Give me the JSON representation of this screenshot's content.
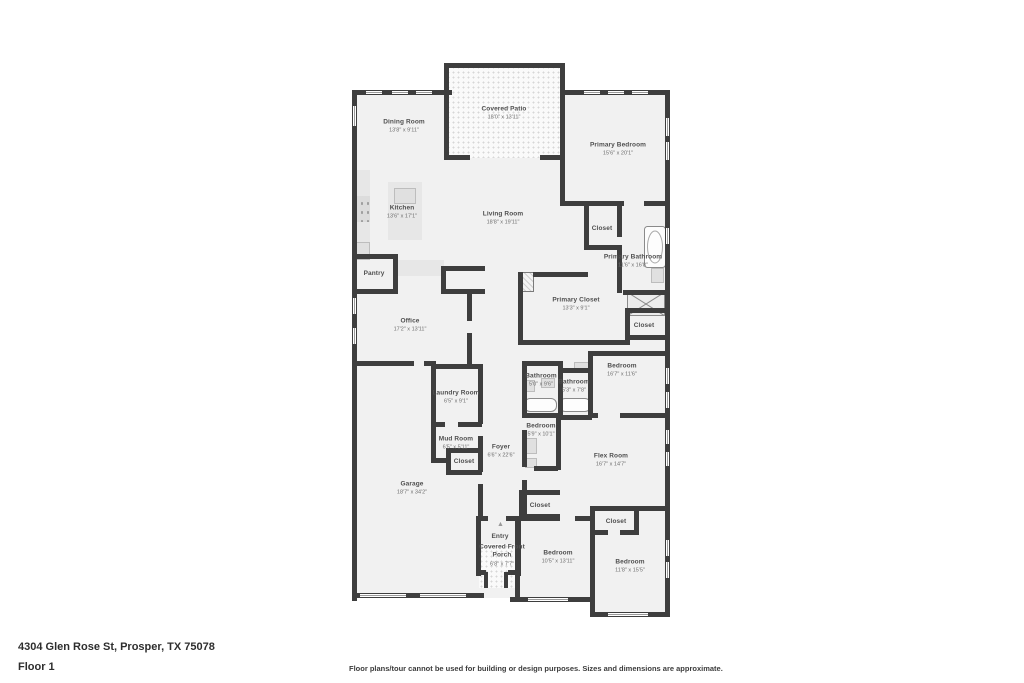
{
  "title": "Floor plan",
  "footer": {
    "address": "4304 Glen Rose St, Prosper, TX 75078",
    "floor_label": "Floor 1",
    "disclaimer": "Floor plans/tour cannot be used for building or design purposes. Sizes and dimensions are approximate."
  },
  "colors": {
    "wall": "#3e3e3e",
    "room_fill": "#f1f1f1",
    "patio_fill": "#fafafa",
    "label_text": "#4f4f4f"
  },
  "icons": {
    "entry_marker": "▲"
  },
  "rooms": [
    {
      "name": "Dining Room",
      "dims": "13'8\" x 9'11\""
    },
    {
      "name": "Covered Patio",
      "dims": "18'0\" x 13'11\""
    },
    {
      "name": "Primary Bedroom",
      "dims": "15'6\" x 20'1\""
    },
    {
      "name": "Kitchen",
      "dims": "13'6\" x 17'1\""
    },
    {
      "name": "Living Room",
      "dims": "18'8\" x 19'11\""
    },
    {
      "name": "Closet"
    },
    {
      "name": "Primary Bathroom",
      "dims": "11'6\" x 16'8\""
    },
    {
      "name": "Pantry"
    },
    {
      "name": "Primary Closet",
      "dims": "13'3\" x 9'1\""
    },
    {
      "name": "Closet"
    },
    {
      "name": "Office",
      "dims": "17'2\" x 13'11\""
    },
    {
      "name": "Bedroom",
      "dims": "16'7\" x 11'6\""
    },
    {
      "name": "Bathroom",
      "dims": "5'0\" x 9'6\""
    },
    {
      "name": "Bathroom",
      "dims": "5'3\" x 7'8\""
    },
    {
      "name": "Laundry Room",
      "dims": "6'5\" x 9'1\""
    },
    {
      "name": "Mud Room",
      "dims": "6'5\" x 5'11\""
    },
    {
      "name": "Closet"
    },
    {
      "name": "Foyer",
      "dims": "6'6\" x 22'6\""
    },
    {
      "name": "Bedroom",
      "dims": "5'9\" x 10'1\""
    },
    {
      "name": "Flex Room",
      "dims": "16'7\" x 14'7\""
    },
    {
      "name": "Garage",
      "dims": "18'7\" x 34'2\""
    },
    {
      "name": "Closet"
    },
    {
      "name": "Entry"
    },
    {
      "name": "Covered Front Porch",
      "dims": "6'8\" x 7'7\""
    },
    {
      "name": "Closet"
    },
    {
      "name": "Bedroom",
      "dims": "10'5\" x 13'11\""
    },
    {
      "name": "Bedroom",
      "dims": "11'8\" x 15'5\""
    }
  ]
}
